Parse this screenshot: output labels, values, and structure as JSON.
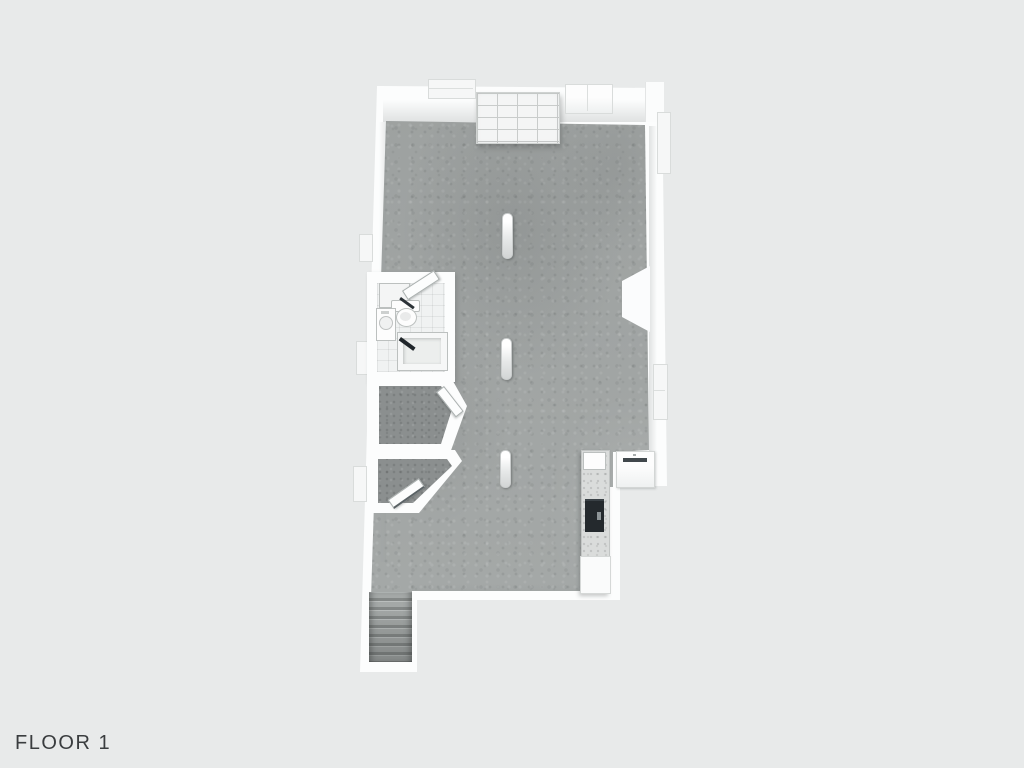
{
  "page": {
    "background_color": "#e8eaea",
    "floor_label": "FLOOR 1",
    "label_color": "#3a3d3f"
  },
  "floorplan": {
    "view": "3D top-down dollhouse render",
    "wall_color": "#fcfdfd",
    "concrete_color": "#a3a7a6",
    "carpet_color": "#8b8f8f",
    "bathroom_tile_color": "#f0f2f2",
    "counter_color": "#dadcdb",
    "range_color": "#24292d",
    "rooms": [
      {
        "name": "main-room",
        "floor": "concrete",
        "features": [
          "shelving-unit",
          "support-columns",
          "chimney-bump"
        ]
      },
      {
        "name": "bathroom",
        "fixtures": [
          "toilet",
          "sink-vanity",
          "bathtub-shower",
          "open-door"
        ]
      },
      {
        "name": "upper-closet",
        "floor": "carpet",
        "fixtures": [
          "open-door"
        ]
      },
      {
        "name": "lower-closet",
        "floor": "carpet",
        "fixtures": [
          "open-door"
        ]
      },
      {
        "name": "kitchen-nook",
        "fixtures": [
          "counter",
          "sink",
          "range",
          "base-cabinet",
          "appliance"
        ]
      },
      {
        "name": "staircase",
        "steps": 7
      }
    ],
    "support_column_count": 3,
    "window_count": 7
  }
}
